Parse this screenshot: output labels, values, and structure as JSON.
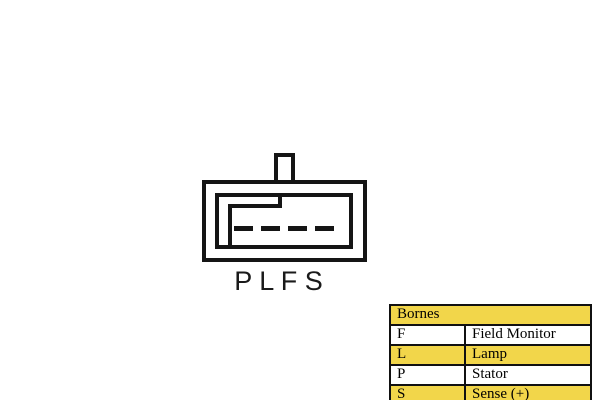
{
  "diagram": {
    "pin_labels": "P L F S",
    "pin_count": 4
  },
  "table": {
    "header": "Bornes",
    "rows": [
      {
        "code": "F",
        "label": "Field Monitor",
        "highlighted": false
      },
      {
        "code": "L",
        "label": "Lamp",
        "highlighted": true
      },
      {
        "code": "P",
        "label": "Stator",
        "highlighted": false
      },
      {
        "code": "S",
        "label": "Sense (+)",
        "highlighted": true
      }
    ]
  },
  "colors": {
    "highlight": "#F2D64A",
    "line": "#151515",
    "text": "#000000",
    "background": "#FFFFFF"
  }
}
